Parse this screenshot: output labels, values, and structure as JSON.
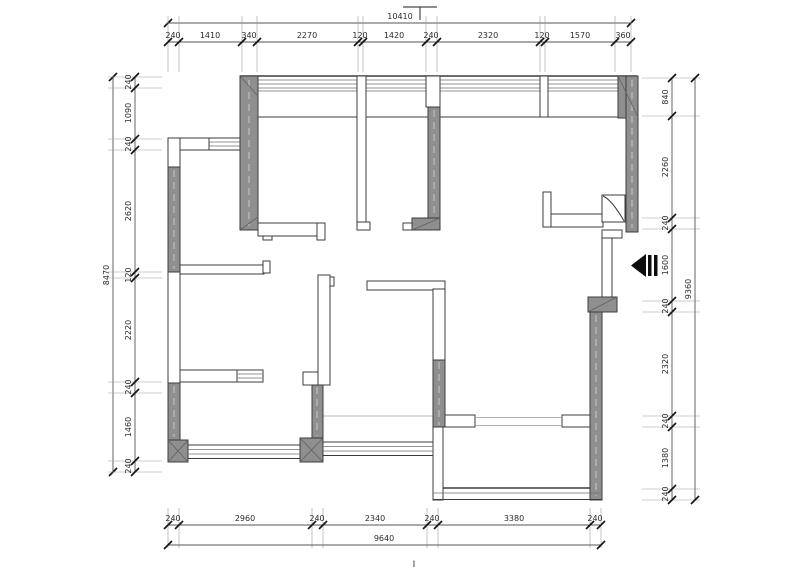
{
  "drawing": {
    "kind": "residential floor plan (CAD dimensioned drawing)",
    "wall_fill_color": "#8f8f8f",
    "line_color": "#3c3c3c",
    "dim_text_color": "#2b2b2b"
  },
  "section_marks": {
    "bottom_label": "I"
  },
  "symbols": {
    "entry_arrow": "entry-arrow-icon (solid black left-pointing arrow with bars)",
    "flue_shaft": "square with diagonal (duct/flue symbol)",
    "section_mark_top": "T-shaped section cut mark"
  },
  "dimensions": {
    "top": {
      "total": "10410",
      "segments": [
        "240",
        "1410",
        "340",
        "2270",
        "120",
        "1420",
        "240",
        "2320",
        "120",
        "1570",
        "360"
      ]
    },
    "bottom": {
      "total": "9640",
      "segments": [
        "240",
        "2960",
        "240",
        "2340",
        "240",
        "3380",
        "240"
      ]
    },
    "left": {
      "total": "8470",
      "segments": [
        "240",
        "1090",
        "240",
        "2620",
        "120",
        "2220",
        "240",
        "1460",
        "240"
      ]
    },
    "right": {
      "total": "9360",
      "segments": [
        "840",
        "2260",
        "240",
        "1600",
        "240",
        "2320",
        "240",
        "1380",
        "240"
      ]
    },
    "rows": [
      {
        "id": "top-total",
        "o": "h",
        "y": 23,
        "x1": 168,
        "x2": 631,
        "ticks": [
          168,
          631
        ],
        "ext": null,
        "labels": [
          {
            "t": "10410",
            "x": 400,
            "y": 19
          }
        ]
      },
      {
        "id": "top-seg",
        "o": "h",
        "y": 42,
        "x1": 168,
        "x2": 631,
        "ticks": [
          168,
          179,
          242,
          257,
          358,
          363,
          426,
          437,
          540,
          545,
          615,
          631
        ],
        "ext": [
          16,
          72
        ],
        "labels": [
          {
            "t": "240",
            "x": 173,
            "y": 38
          },
          {
            "t": "1410",
            "x": 210,
            "y": 38
          },
          {
            "t": "340",
            "x": 249,
            "y": 38
          },
          {
            "t": "2270",
            "x": 307,
            "y": 38
          },
          {
            "t": "120",
            "x": 360,
            "y": 38
          },
          {
            "t": "1420",
            "x": 394,
            "y": 38
          },
          {
            "t": "240",
            "x": 431,
            "y": 38
          },
          {
            "t": "2320",
            "x": 488,
            "y": 38
          },
          {
            "t": "120",
            "x": 542,
            "y": 38
          },
          {
            "t": "1570",
            "x": 580,
            "y": 38
          },
          {
            "t": "360",
            "x": 623,
            "y": 38
          }
        ]
      },
      {
        "id": "bottom-seg",
        "o": "h",
        "y": 525,
        "x1": 168,
        "x2": 601,
        "ticks": [
          168,
          179,
          312,
          323,
          427,
          438,
          590,
          601
        ],
        "ext": [
          508,
          548
        ],
        "labels": [
          {
            "t": "240",
            "x": 173,
            "y": 521
          },
          {
            "t": "2960",
            "x": 245,
            "y": 521
          },
          {
            "t": "240",
            "x": 317,
            "y": 521
          },
          {
            "t": "2340",
            "x": 375,
            "y": 521
          },
          {
            "t": "240",
            "x": 432,
            "y": 521
          },
          {
            "t": "3380",
            "x": 514,
            "y": 521
          },
          {
            "t": "240",
            "x": 595,
            "y": 521
          }
        ]
      },
      {
        "id": "bottom-total",
        "o": "h",
        "y": 545,
        "x1": 168,
        "x2": 601,
        "ticks": [
          168,
          601
        ],
        "ext": null,
        "labels": [
          {
            "t": "9640",
            "x": 384,
            "y": 541
          }
        ]
      },
      {
        "id": "left-total",
        "o": "v",
        "x": 113,
        "y1": 77,
        "y2": 472,
        "ticks": [
          77,
          472
        ],
        "ext": null,
        "labels": [
          {
            "t": "8470",
            "x": 109,
            "y": 275
          }
        ]
      },
      {
        "id": "left-seg",
        "o": "v",
        "x": 135,
        "y1": 77,
        "y2": 472,
        "ticks": [
          77,
          88,
          139,
          150,
          272,
          278,
          382,
          393,
          461,
          472
        ],
        "ext": [
          108,
          162
        ],
        "labels": [
          {
            "t": "240",
            "x": 131,
            "y": 82
          },
          {
            "t": "1090",
            "x": 131,
            "y": 113
          },
          {
            "t": "240",
            "x": 131,
            "y": 144
          },
          {
            "t": "2620",
            "x": 131,
            "y": 211
          },
          {
            "t": "120",
            "x": 131,
            "y": 275
          },
          {
            "t": "2220",
            "x": 131,
            "y": 330
          },
          {
            "t": "240",
            "x": 131,
            "y": 387
          },
          {
            "t": "1460",
            "x": 131,
            "y": 427
          },
          {
            "t": "240",
            "x": 131,
            "y": 466
          }
        ]
      },
      {
        "id": "right-seg",
        "o": "v",
        "x": 672,
        "y1": 78,
        "y2": 500,
        "ticks": [
          78,
          116,
          218,
          229,
          301,
          312,
          416,
          427,
          489,
          500
        ],
        "ext": [
          642,
          700
        ],
        "labels": [
          {
            "t": "840",
            "x": 668,
            "y": 97
          },
          {
            "t": "2260",
            "x": 668,
            "y": 167
          },
          {
            "t": "240",
            "x": 668,
            "y": 223
          },
          {
            "t": "1600",
            "x": 668,
            "y": 265
          },
          {
            "t": "240",
            "x": 668,
            "y": 306
          },
          {
            "t": "2320",
            "x": 668,
            "y": 364
          },
          {
            "t": "240",
            "x": 668,
            "y": 421
          },
          {
            "t": "1380",
            "x": 668,
            "y": 458
          },
          {
            "t": "240",
            "x": 668,
            "y": 494
          }
        ]
      },
      {
        "id": "right-total",
        "o": "v",
        "x": 695,
        "y1": 78,
        "y2": 500,
        "ticks": [
          78,
          500
        ],
        "ext": null,
        "labels": [
          {
            "t": "9360",
            "x": 691,
            "y": 289
          }
        ]
      }
    ]
  }
}
